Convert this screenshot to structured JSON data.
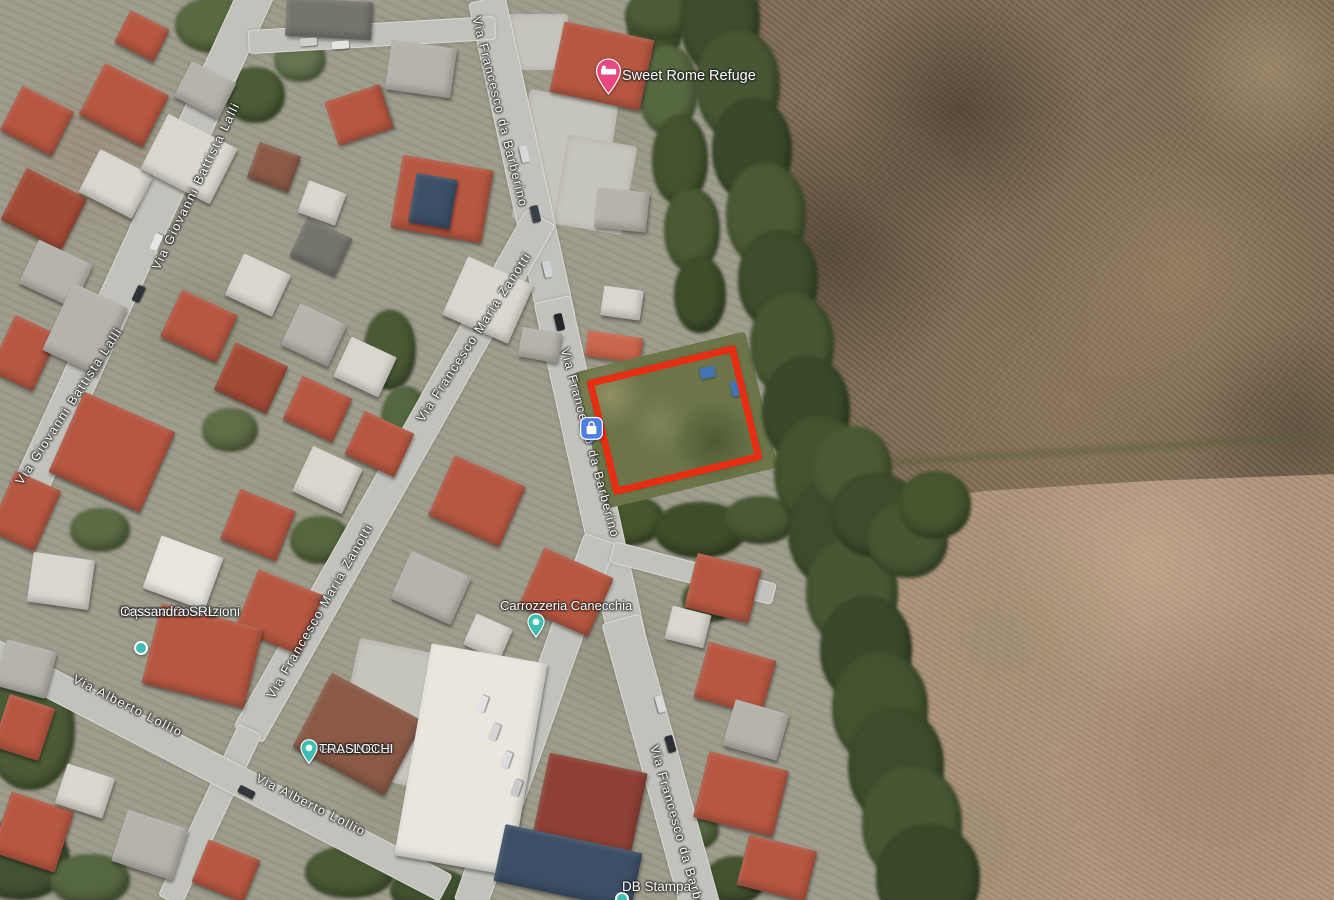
{
  "map": {
    "view_type": "satellite",
    "overlay": {
      "parcel_highlight_color": "#e72d12"
    },
    "road_labels": [
      {
        "text": "Via Francesco da Barberino",
        "x": 500,
        "y": 112,
        "rotate": 76
      },
      {
        "text": "Via Giovanni Battista Lalli",
        "x": 196,
        "y": 186,
        "rotate": -64
      },
      {
        "text": "Via Giovanni Battista Lalli",
        "x": 69,
        "y": 406,
        "rotate": -57
      },
      {
        "text": "Via Francesco Maria Zanotti",
        "x": 474,
        "y": 337,
        "rotate": -57
      },
      {
        "text": "Via Francesco Maria Zanotti",
        "x": 320,
        "y": 611,
        "rotate": -60
      },
      {
        "text": "Via Francesco da Barberino",
        "x": 590,
        "y": 443,
        "rotate": 75
      },
      {
        "text": "Via Alberto Lollio",
        "x": 128,
        "y": 706,
        "rotate": 27
      },
      {
        "text": "Via Alberto Lollio",
        "x": 311,
        "y": 805,
        "rotate": 27
      },
      {
        "text": "Via Francesco da Barberino",
        "x": 681,
        "y": 840,
        "rotate": 74
      }
    ],
    "places": [
      {
        "id": "sweet-rome-refuge",
        "lines": [
          "Sweet Rome Refuge"
        ],
        "pin": "hotel",
        "pin_color": "#e8487f",
        "pin_x": 608,
        "pin_y": 74,
        "text_x": 622,
        "text_y": 68,
        "align": "left",
        "font": 14.5
      },
      {
        "id": "ideaflex",
        "lines": [
          "Ideaflex Vendita",
          "Reti e Materassi"
        ],
        "sub": "Mattress store",
        "pin": "shopping",
        "pin_color": "#4d7de2",
        "pin_x": 591,
        "pin_y": 429,
        "text_x": 582,
        "text_y": 416,
        "align": "right",
        "font": 13.5
      },
      {
        "id": "impresa-costruzioni",
        "lines": [
          "Impresa Costruzioni",
          "Cassandra SRL"
        ],
        "pin": "dot",
        "pin_color": "#3fbdb2",
        "pin_x": 141,
        "pin_y": 648,
        "text_x": 120,
        "text_y": 604,
        "align": "left",
        "font": 13.5
      },
      {
        "id": "gallinelli-traslochi",
        "lines": [
          "GALLINELLI",
          "TRASLOCHI"
        ],
        "pin": "poi",
        "pin_color": "#3fbdb2",
        "pin_x": 309,
        "pin_y": 750,
        "text_x": 319,
        "text_y": 742,
        "align": "left",
        "font": 13
      },
      {
        "id": "carrozzeria-canecchia",
        "lines": [
          "Carrozzeria Canecchia"
        ],
        "pin": "poi",
        "pin_color": "#3fbdb2",
        "pin_x": 536,
        "pin_y": 624,
        "text_x": 500,
        "text_y": 599,
        "align": "center",
        "font": 13
      },
      {
        "id": "db-stampa",
        "lines": [
          "DB Stampa"
        ],
        "pin": "dot",
        "pin_color": "#3fbdb2",
        "pin_x": 622,
        "pin_y": 899,
        "text_x": 622,
        "text_y": 879,
        "align": "center",
        "font": 13.5
      }
    ]
  }
}
